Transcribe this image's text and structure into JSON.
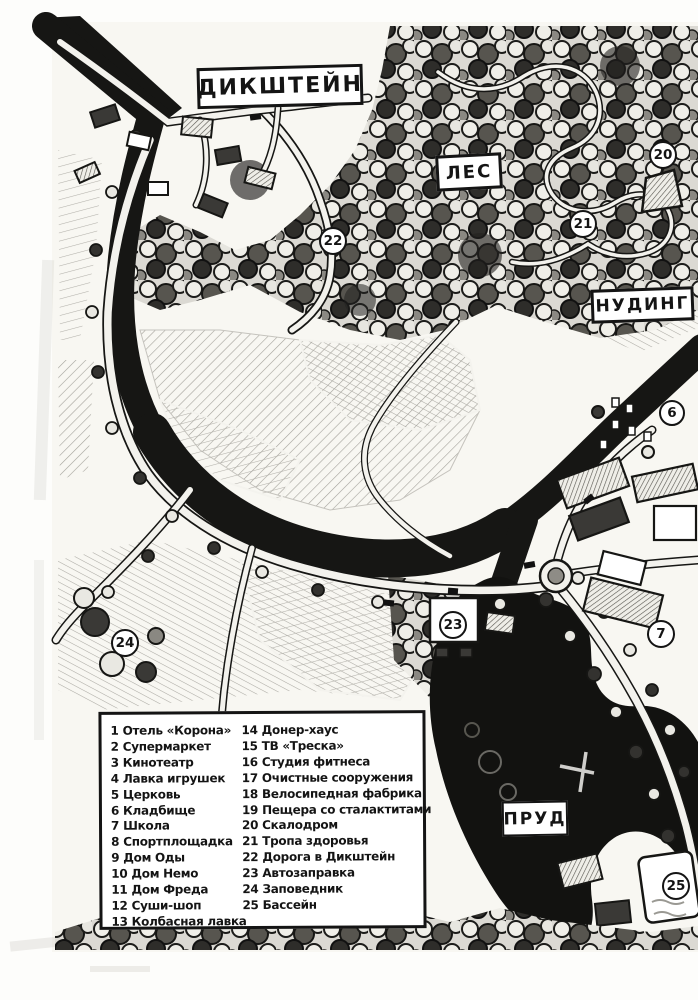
{
  "colors": {
    "ink": "#161614",
    "paper": "#f8f7f2",
    "pond_black": "#121210"
  },
  "map": {
    "labels": {
      "dikstein": "ДИКШТЕЙН",
      "forest": "ЛЕС",
      "nuding": "НУДИНГ",
      "pond": "ПРУД"
    },
    "markers": [
      {
        "number": "20"
      },
      {
        "number": "21"
      },
      {
        "number": "22"
      },
      {
        "number": "6"
      },
      {
        "number": "7"
      },
      {
        "number": "23"
      },
      {
        "number": "24"
      },
      {
        "number": "25"
      }
    ]
  },
  "legend": {
    "col1": [
      {
        "n": "1",
        "t": "Отель «Корона»"
      },
      {
        "n": "2",
        "t": "Супермаркет"
      },
      {
        "n": "3",
        "t": "Кинотеатр"
      },
      {
        "n": "4",
        "t": "Лавка игрушек"
      },
      {
        "n": "5",
        "t": "Церковь"
      },
      {
        "n": "6",
        "t": "Кладбище"
      },
      {
        "n": "7",
        "t": "Школа"
      },
      {
        "n": "8",
        "t": "Спортплощадка"
      },
      {
        "n": "9",
        "t": "Дом Оды"
      },
      {
        "n": "10",
        "t": "Дом Немо"
      },
      {
        "n": "11",
        "t": "Дом Фреда"
      },
      {
        "n": "12",
        "t": "Суши-шоп"
      },
      {
        "n": "13",
        "t": "Колбасная лавка"
      }
    ],
    "col2": [
      {
        "n": "14",
        "t": "Донер-хаус"
      },
      {
        "n": "15",
        "t": "ТВ «Треска»"
      },
      {
        "n": "16",
        "t": "Студия фитнеса"
      },
      {
        "n": "17",
        "t": "Очистные сооружения"
      },
      {
        "n": "18",
        "t": "Велосипедная фабрика"
      },
      {
        "n": "19",
        "t": "Пещера со сталактитами"
      },
      {
        "n": "20",
        "t": "Скалодром"
      },
      {
        "n": "21",
        "t": "Тропа здоровья"
      },
      {
        "n": "22",
        "t": "Дорога в Дикштейн"
      },
      {
        "n": "23",
        "t": "Автозаправка"
      },
      {
        "n": "24",
        "t": "Заповедник"
      },
      {
        "n": "25",
        "t": "Бассейн"
      }
    ]
  }
}
